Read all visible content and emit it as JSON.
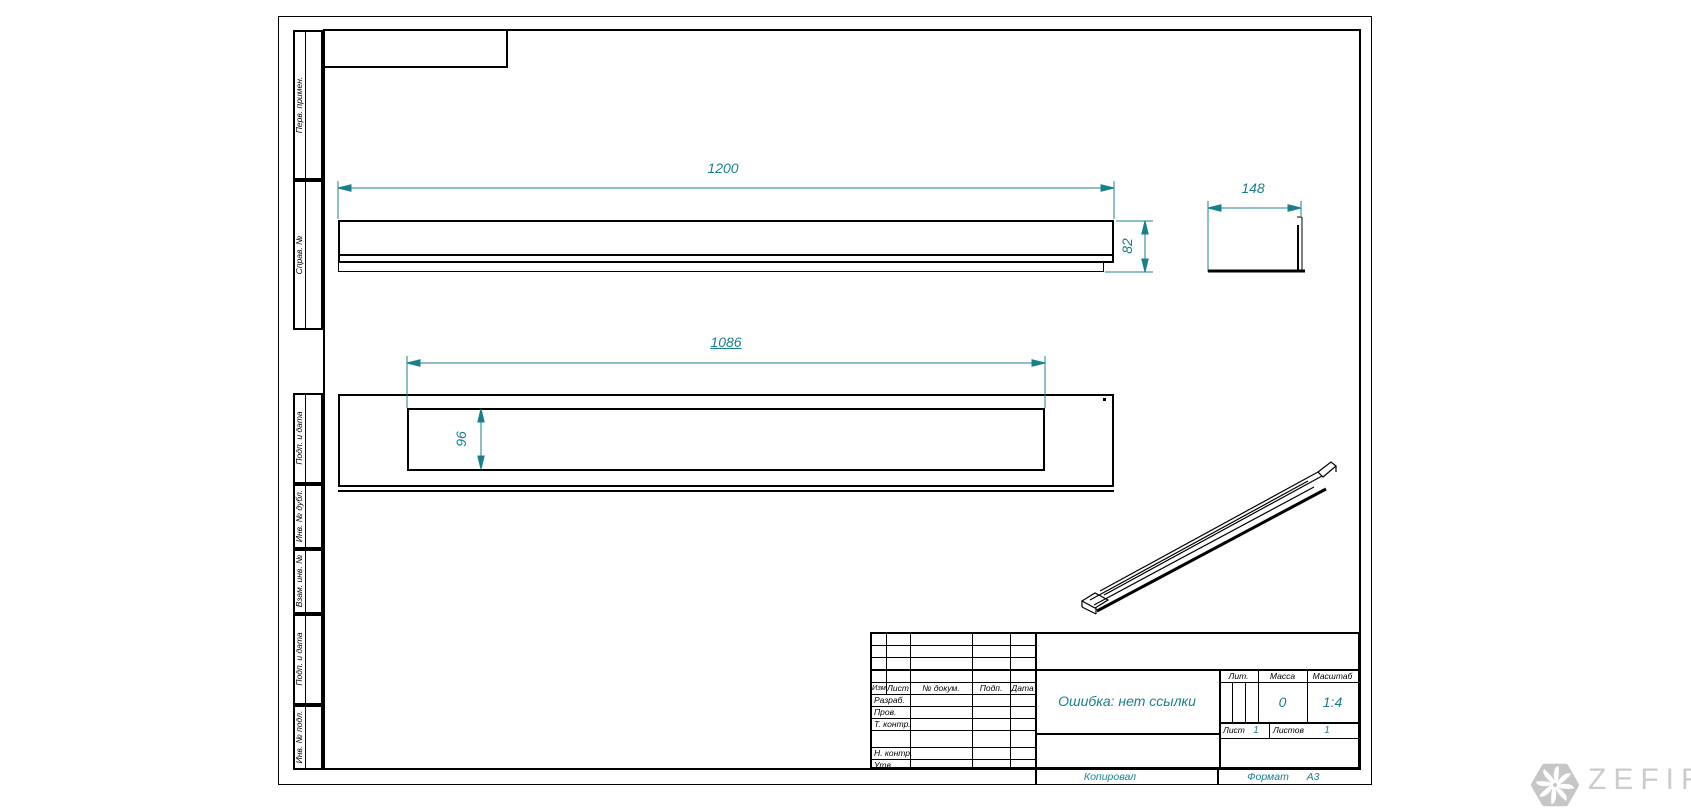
{
  "colors": {
    "dimension_teal": "#19808b",
    "drawing_line": "#000000",
    "watermark_gray": "#c8c6c5"
  },
  "margin_labels": [
    "Перв. примен.",
    "Справ. №",
    "Подп. и дата",
    "Инв. № дубл.",
    "Взам. инв. №",
    "Подп. и дата",
    "Инв. № подл."
  ],
  "views": {
    "front": {
      "length_dim": "1200",
      "height_dim": "82"
    },
    "side": {
      "width_dim": "148"
    },
    "top": {
      "cutout_length_dim": "1086",
      "cutout_width_dim": "96"
    }
  },
  "title_block": {
    "header": [
      "Изм.",
      "Лист",
      "№ докум.",
      "Подп.",
      "Дата"
    ],
    "rows": [
      "Разраб.",
      "Пров.",
      "Т. контр.",
      "Н. контр.",
      "Утв."
    ],
    "doc_title": "Ошибка: нет ссылки",
    "lit_label": "Лит.",
    "mass_label": "Масса",
    "scale_label": "Масштаб",
    "mass_value": "0",
    "scale_value": "1:4",
    "sheet_label": "Лист",
    "sheet_value": "1",
    "sheets_label": "Листов",
    "sheets_value": "1"
  },
  "footer": {
    "copied": "Копировал",
    "format_label": "Формат",
    "format_value": "А3"
  },
  "watermark": {
    "brand": "ZEFIRE"
  }
}
